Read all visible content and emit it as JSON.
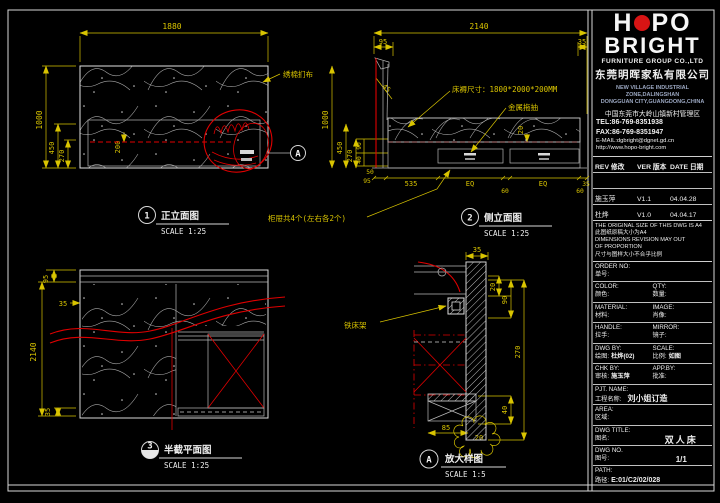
{
  "colors": {
    "background": "#000000",
    "lines": "#d8d8d8",
    "dimensions": "#d9c400",
    "highlight_red": "#e00000",
    "logo_red": "#d81414"
  },
  "company": {
    "logo_h": "H",
    "logo_po": "PO",
    "logo_bright": "BRIGHT",
    "subtitle": "FURNITURE GROUP CO.,LTD",
    "name_cn": "东莞明晖家私有限公司",
    "addr_en1": "NEW VILLAGE INDUSTRIAL ZONE,DALINGSHAN",
    "addr_en2": "DONGGUAN CITY,GUANGDONG,CHINA",
    "addr_cn": "中国东莞市大岭山镇新村管理区",
    "tel": "TEL:86-769-8351938",
    "fax": "FAX:86-769-8351947",
    "email": "E-MAIL:dgbright@dgnet.gd.cn",
    "web": "http://www.hopo-bright.com"
  },
  "revisions": {
    "headers": {
      "rev": "REV 修改",
      "ver": "VER 版本",
      "date": "DATE 日期"
    },
    "rows": [
      {
        "rev": "",
        "ver": "",
        "date": ""
      },
      {
        "rev": "施玉萍",
        "ver": "V1.1",
        "date": "04.04.28"
      },
      {
        "rev": "杜烨",
        "ver": "V1.0",
        "date": "04.04.17"
      }
    ]
  },
  "notes": {
    "en1": "THE ORIGINAL SIZE OF THIS DWG IS A4",
    "cn1": "此图纸原稿大小为A4",
    "en2": "DIMENSIONS REVISION MAY OUT",
    "en3": "OF PROPORTION",
    "cn2": "尺寸与图样大小不合乎比例"
  },
  "fields": {
    "order_no": {
      "en": "ORDER NO:",
      "cn": "单号:",
      "value": ""
    },
    "color": {
      "en": "COLOR:",
      "cn": "颜色:",
      "value": ""
    },
    "qty": {
      "en": "QTY:",
      "cn": "数量:",
      "value": ""
    },
    "material": {
      "en": "MATERIAL:",
      "cn": "材料:",
      "value": ""
    },
    "image": {
      "en": "IMAGE:",
      "cn": "肖像:",
      "value": ""
    },
    "handle": {
      "en": "HANDLE:",
      "cn": "拉手:",
      "value": ""
    },
    "mirror": {
      "en": "MIRROR:",
      "cn": "镜子:",
      "value": ""
    },
    "dwg_by": {
      "en": "DWG BY:",
      "cn": "绘图:",
      "value": "杜烨(02)"
    },
    "scale": {
      "en": "SCALE:",
      "cn": "比例:",
      "value": "如图"
    },
    "chk_by": {
      "en": "CHK BY:",
      "cn": "审核:",
      "value": "施玉萍"
    },
    "app_by": {
      "en": "APP.BY:",
      "cn": "批准:",
      "value": ""
    },
    "pjt_name": {
      "en": "PJT. NAME:",
      "cn": "工程名称:",
      "value": "刘小姐订造"
    },
    "area": {
      "en": "AREA:",
      "cn": "区域:",
      "value": ""
    },
    "dwg_title": {
      "en": "DWG TITLE:",
      "cn": "图名:",
      "value": "双人床"
    },
    "dwg_no": {
      "en": "DWG NO.",
      "cn": "图号:",
      "value": "1/1"
    },
    "path": {
      "en": "PATH:",
      "cn": "路径:",
      "value": "E:01/C2/02/028"
    }
  },
  "drawings": {
    "front": {
      "callout_id": "1",
      "title": "正立面图",
      "scale": "SCALE 1:25",
      "detail_ref": "A",
      "upholstery_label": "绣棉扪布",
      "drawer_note": "柜屉共4个(左右各2个)",
      "dims": {
        "width": "1880",
        "height": "1000",
        "h450": "450",
        "h270": "270",
        "d200": "200"
      }
    },
    "side": {
      "callout_id": "2",
      "title": "侧立面图",
      "scale": "SCALE 1:25",
      "mattress_note": "床褥尺寸：1800*2000*200MM",
      "slides_label": "金属拖抽",
      "dims": {
        "width": "2140",
        "d95": "95",
        "d35": "35",
        "d45": "45",
        "height": "1000",
        "h450": "450",
        "h270": "270",
        "h90": "90",
        "h40": "40",
        "h50": "50",
        "h95": "95",
        "d535": "535",
        "eq1": "EQ",
        "d60a": "60",
        "eq2": "EQ",
        "d60b": "60",
        "d35b": "35",
        "d20": "20"
      }
    },
    "plan": {
      "callout_id": "3",
      "title": "半截平面图",
      "scale": "SCALE 1:25",
      "dims": {
        "d95": "95",
        "d35a": "35",
        "length": "2140",
        "d35b": "35"
      }
    },
    "detail": {
      "callout_id": "A",
      "title": "放大样图",
      "scale": "SCALE 1:5",
      "frame_label": "铁床架",
      "dims": {
        "d35": "35",
        "d20": "20",
        "d90": "90",
        "d270": "270",
        "d40": "40",
        "d85": "85",
        "d20c": "20"
      }
    }
  }
}
